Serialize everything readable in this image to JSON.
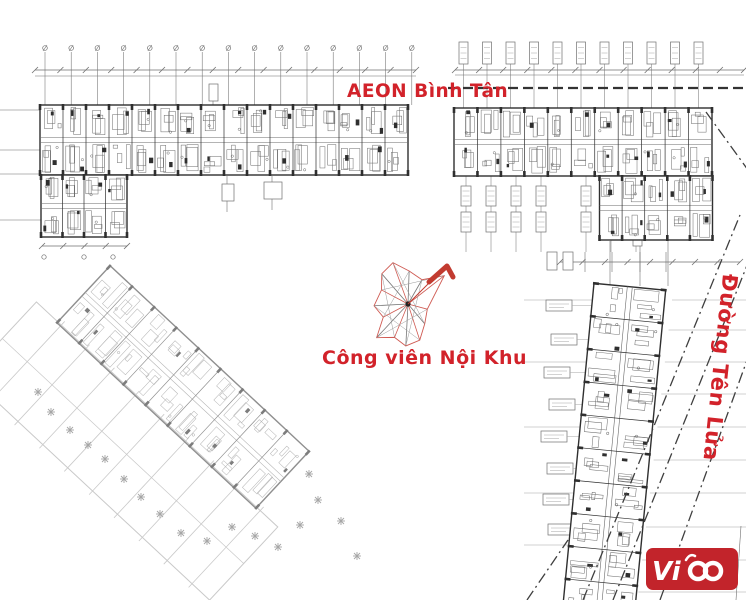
{
  "labels": {
    "aeon": {
      "text": "AEON Bình Tân"
    },
    "park": {
      "text": "Công viên Nội Khu"
    },
    "street": {
      "text": "Đường Tên Lửa"
    },
    "logo": {
      "text": "Vi"
    }
  },
  "colors": {
    "label_red": "#d2222a",
    "logo_red": "#c2242b",
    "ink": "#2f2f2f",
    "mid": "#6f6f6f",
    "light": "#a6a6a6",
    "faint": "#c9c9c9",
    "compass_red": "#cf5a52",
    "compass_arrow": "#c23b30",
    "road": "#3f3f3f",
    "boundary": "#333333"
  },
  "plan": {
    "blocks": [
      {
        "name": "block-a-bar",
        "cx": 224,
        "cy": 140,
        "len": 368,
        "wid": 70,
        "rot": 0,
        "units": 16,
        "tone": "dark"
      },
      {
        "name": "block-a-wing",
        "cx": 84,
        "cy": 206,
        "len": 86,
        "wid": 62,
        "rot": 0,
        "units": 4,
        "tone": "dark"
      },
      {
        "name": "block-b-bar",
        "cx": 583,
        "cy": 142,
        "len": 258,
        "wid": 68,
        "rot": 0,
        "units": 11,
        "tone": "dark"
      },
      {
        "name": "block-b-ext",
        "cx": 656,
        "cy": 208,
        "len": 113,
        "wid": 64,
        "rot": 0,
        "units": 5,
        "tone": "dark"
      },
      {
        "name": "block-c-tower",
        "cx": 614,
        "cy": 451,
        "len": 330,
        "wid": 72,
        "rot": 95.5,
        "units": 10,
        "tone": "dark"
      },
      {
        "name": "block-d-diagonal",
        "cx": 183,
        "cy": 387,
        "len": 272,
        "wid": 78,
        "rot": 43,
        "units": 9,
        "tone": "light"
      }
    ],
    "ghost": {
      "cx": 123,
      "cy": 451,
      "len": 330,
      "wid": 100,
      "rot": 43,
      "step": 34
    },
    "markers": [
      [
        38,
        392
      ],
      [
        51,
        412
      ],
      [
        70,
        430
      ],
      [
        88,
        445
      ],
      [
        105,
        459
      ],
      [
        124,
        479
      ],
      [
        141,
        497
      ],
      [
        160,
        514
      ],
      [
        181,
        533
      ],
      [
        207,
        541
      ],
      [
        232,
        527
      ],
      [
        255,
        536
      ],
      [
        278,
        547
      ],
      [
        300,
        525
      ],
      [
        318,
        500
      ],
      [
        309,
        474
      ],
      [
        341,
        521
      ],
      [
        357,
        556
      ]
    ],
    "roads": [
      [
        583,
        600,
        740,
        215
      ],
      [
        613,
        600,
        766,
        218
      ],
      [
        660,
        600,
        750,
        352
      ],
      [
        706,
        112,
        748,
        170
      ],
      [
        527,
        600,
        568,
        540
      ]
    ],
    "boundary": [
      448,
      88,
      746,
      88
    ],
    "dimlines": [
      [
        35,
        70,
        416,
        70,
        15
      ],
      [
        455,
        70,
        744,
        70,
        12
      ],
      [
        42,
        246,
        127,
        246,
        4
      ],
      [
        560,
        262,
        740,
        262,
        8
      ]
    ],
    "dimcircles": [
      [
        44,
        257
      ],
      [
        84,
        257
      ],
      [
        113,
        257
      ]
    ],
    "gridv": {
      "x0": 45,
      "dx": 26.2,
      "count": 15,
      "y1": 52,
      "y2": 105
    },
    "tagrow": {
      "x0": 459,
      "dx": 23.5,
      "count": 11,
      "y": 42,
      "w": 9,
      "h": 22,
      "lineY": 108
    },
    "tagcols": {
      "xs": [
        466,
        491,
        516,
        541,
        586,
        611,
        636
      ],
      "y1": 176,
      "y2": 252,
      "boxY1": 186,
      "boxY2": 212
    },
    "sidetags": [
      [
        546,
        300,
        592
      ],
      [
        551,
        334,
        590
      ],
      [
        544,
        367,
        588
      ],
      [
        549,
        399,
        586
      ],
      [
        541,
        431,
        584
      ],
      [
        547,
        463,
        582
      ],
      [
        543,
        494,
        580
      ],
      [
        548,
        524,
        578
      ]
    ],
    "tagboxes": [
      [
        209,
        84,
        9,
        17
      ],
      [
        222,
        184,
        12,
        17
      ],
      [
        264,
        182,
        18,
        17
      ],
      [
        633,
        224,
        9,
        22
      ],
      [
        547,
        252,
        10,
        18
      ],
      [
        563,
        252,
        10,
        18
      ]
    ],
    "grid_right": {
      "ys": [
        300,
        330,
        362,
        394,
        427,
        460,
        493,
        527,
        560,
        592
      ],
      "xbase": 672,
      "ytop": 300,
      "slope": 0.115,
      "x2": 746
    },
    "grid_left": {
      "ys": [
        300,
        362,
        427,
        493,
        545
      ],
      "x1": 524,
      "xbase": 600,
      "ytop": 287,
      "slope": 0.1
    },
    "lines": [
      [
        0,
        110,
        42,
        110
      ],
      [
        0,
        150,
        42,
        150
      ],
      [
        0,
        174,
        42,
        174
      ],
      [
        0,
        220,
        42,
        220
      ],
      [
        213,
        101,
        213,
        106
      ],
      [
        227,
        176,
        227,
        212
      ],
      [
        272,
        176,
        272,
        210
      ],
      [
        610,
        241,
        610,
        286
      ],
      [
        640,
        241,
        640,
        286
      ],
      [
        668,
        241,
        668,
        286
      ],
      [
        585,
        252,
        585,
        272
      ],
      [
        612,
        252,
        612,
        272
      ],
      [
        640,
        252,
        640,
        272
      ],
      [
        666,
        252,
        666,
        272
      ],
      [
        35,
        76,
        416,
        76
      ],
      [
        455,
        75,
        744,
        75
      ],
      [
        634,
        534,
        630,
        600
      ],
      [
        741,
        526,
        736,
        600
      ]
    ],
    "compass": {
      "cx": 408,
      "cy": 304,
      "spokes": [
        [
          -38,
          46,
          "r"
        ],
        [
          -60,
          28,
          "g"
        ],
        [
          -88,
          33,
          "g"
        ],
        [
          -110,
          44,
          "r"
        ],
        [
          -131,
          40,
          "g"
        ],
        [
          -152,
          30,
          "r"
        ],
        [
          177,
          34,
          "g"
        ],
        [
          152,
          28,
          "r"
        ],
        [
          133,
          46,
          "g"
        ],
        [
          112,
          36,
          "r"
        ],
        [
          93,
          42,
          "g"
        ],
        [
          72,
          38,
          "r"
        ],
        [
          50,
          26,
          "g"
        ],
        [
          15,
          20,
          "r"
        ]
      ],
      "arrow": "M429,282 L447,266 L453,277",
      "arrow_line": [
        408,
        304,
        441,
        271
      ]
    }
  }
}
